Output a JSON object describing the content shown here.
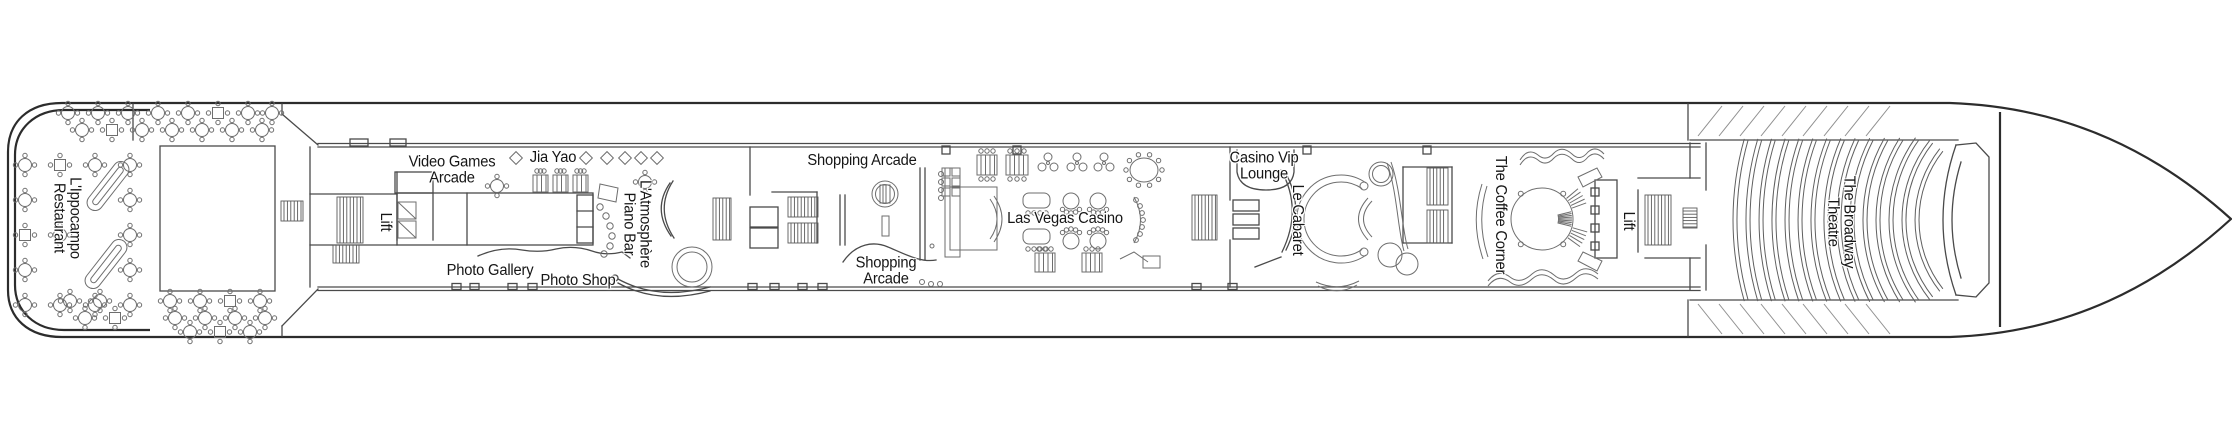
{
  "labels": {
    "restaurant": {
      "line1": "L'Ippocampo",
      "line2": "Restaurant"
    },
    "lift_aft": "Lift",
    "video_games": {
      "line1": "Video Games",
      "line2": "Arcade"
    },
    "jia_yao": "Jia Yao",
    "piano_bar": {
      "line1": "L'Atmosphère",
      "line2": "Piano Bar"
    },
    "photo_gallery": "Photo Gallery",
    "photo_shop": "Photo Shop",
    "shopping_arcade_top": "Shopping Arcade",
    "shopping_arcade_bottom": {
      "line1": "Shopping",
      "line2": "Arcade"
    },
    "las_vegas_casino": "Las Vegas Casino",
    "casino_vip": {
      "line1": "Casino Vip",
      "line2": "Lounge"
    },
    "le_cabaret": "Le Cabaret",
    "coffee_corner": "The Coffee Corner",
    "lift_fwd": "Lift",
    "broadway": {
      "line1": "The Broadway",
      "line2": "Theatre"
    }
  },
  "colors": {
    "background": "#ffffff",
    "hull_line": "#2c2c2c",
    "wall_line": "#4a4a4a",
    "furniture_line": "#6e6e6e",
    "text": "#161616"
  }
}
